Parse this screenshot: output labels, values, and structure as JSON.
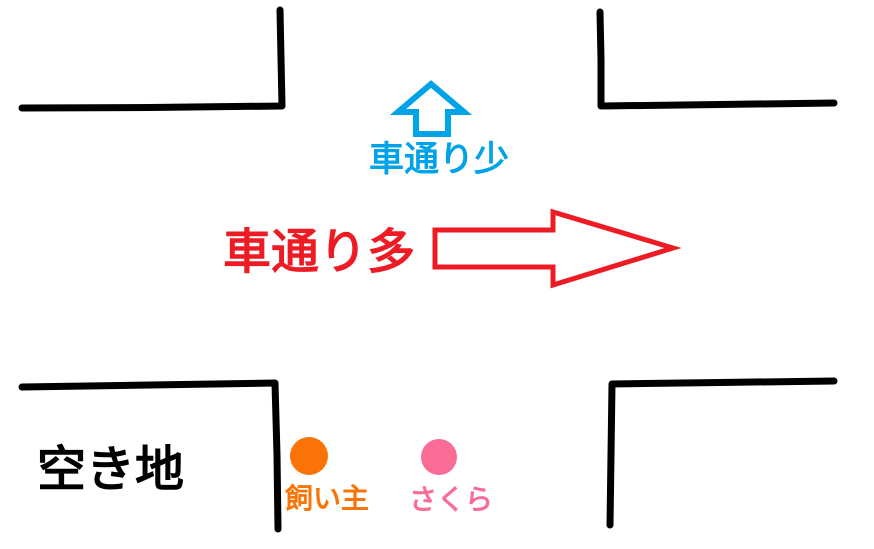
{
  "canvas": {
    "background": "#FFFFFF"
  },
  "colors": {
    "road": "#000000",
    "low_traffic": "#00A2E8",
    "high_traffic": "#ED1C24",
    "vacant_lot": "#000000",
    "owner": "#F97306",
    "sakura": "#FA6B96",
    "arrow_fill": "#FFFFFF"
  },
  "labels": {
    "low_traffic": "車通り少",
    "high_traffic": "車通り多",
    "vacant_lot": "空き地",
    "owner": "飼い主",
    "sakura": "さくら"
  }
}
